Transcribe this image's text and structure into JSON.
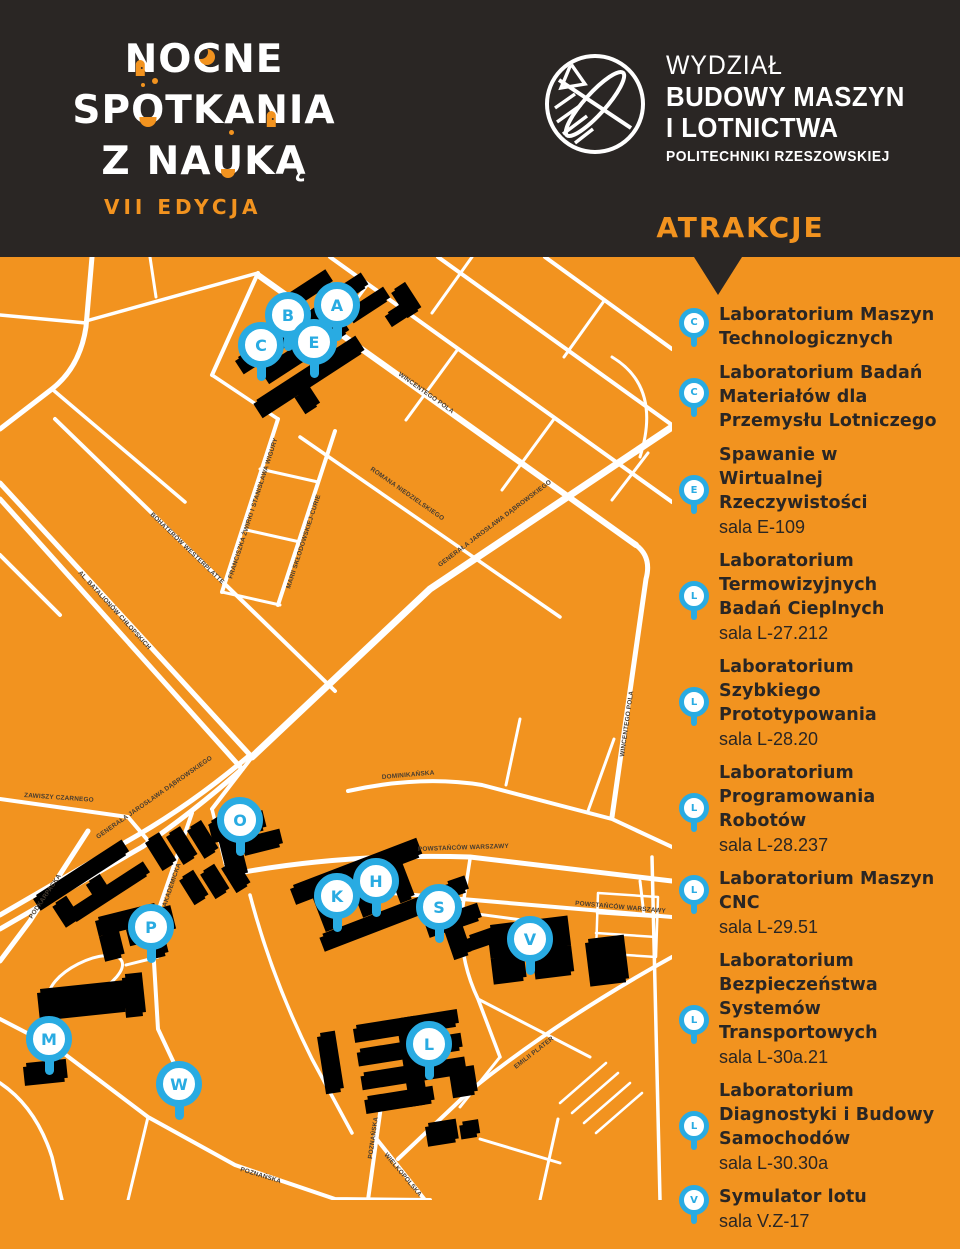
{
  "theme": {
    "orange": "#F2931F",
    "dark": "#2A2624",
    "blue": "#29ABE2",
    "building_black": "#1E1B19",
    "building_gray": "#57524D",
    "white": "#FFFFFF"
  },
  "header": {
    "wordmark": {
      "l1": [
        "N",
        "O",
        "C",
        "N",
        "E"
      ],
      "l2": [
        "S",
        "P",
        "O",
        "T",
        "K",
        "A",
        "N",
        "I",
        "A"
      ],
      "l3": [
        "Z",
        "N",
        "A",
        "U",
        "K",
        "Ą"
      ],
      "edition": "VII EDYCJA"
    },
    "faculty": {
      "line1": "WYDZIAŁ",
      "line2": "BUDOWY MASZYN",
      "line3": "I LOTNICTWA",
      "line4": "POLITECHNIKI RZESZOWSKIEJ"
    },
    "attractions_heading": "ATRAKCJE"
  },
  "map": {
    "pins": [
      {
        "letter": "A"
      },
      {
        "letter": "B"
      },
      {
        "letter": "C"
      },
      {
        "letter": "E"
      },
      {
        "letter": "O"
      },
      {
        "letter": "K"
      },
      {
        "letter": "H"
      },
      {
        "letter": "S"
      },
      {
        "letter": "V"
      },
      {
        "letter": "P"
      },
      {
        "letter": "M"
      },
      {
        "letter": "W"
      },
      {
        "letter": "L"
      }
    ],
    "streets": {
      "al_batalionow": "AL. BATALIONÓW CHŁOPSKICH",
      "bohaterow": "BOHATERÓW WESTERPLATTE",
      "zwirki": "FRANCISZKA ŻWIRKI I STANISŁAWA WIGURY",
      "sklodowskiej": "MARII SKŁODOWSKIEJ-CURIE",
      "wincentego1": "WINCENTEGO POLA",
      "wincentego2": "WINCENTEGO POLA",
      "niedzielskiego": "ROMANA NIEDZIELSKIEGO",
      "dabrowskiego1": "GENERAŁA JAROSŁAWA DĄBROWSKIEGO",
      "dabrowskiego2": "GENERAŁA JAROSŁAWA DĄBROWSKIEGO",
      "zawiszy": "ZAWISZY CZARNEGO",
      "podkarpacka": "PODKARPACKA",
      "dominikanska": "DOMINIKAŃSKA",
      "powstancow1": "POWSTAŃCÓW WARSZAWY",
      "powstancow2": "POWSTAŃCÓW WARSZAWY",
      "akademicka": "AKADEMICKA",
      "poznanska1": "POZNAŃSKA",
      "poznanska2": "POZNAŃSKA",
      "wielkopolska": "WIELKOPOLSKA",
      "emilii": "EMILII PLATER"
    }
  },
  "sidebar": {
    "items": [
      {
        "letter": "C",
        "title": "Laboratorium Maszyn Technologicznych",
        "sala": ""
      },
      {
        "letter": "C",
        "title": "Laboratorium Badań Materiałów dla Przemysłu Lotniczego",
        "sala": ""
      },
      {
        "letter": "E",
        "title": "Spawanie w Wirtualnej Rzeczywistości",
        "sala": "sala E-109"
      },
      {
        "letter": "L",
        "title": "Laboratorium Termowizyjnych Badań Cieplnych",
        "sala": "sala L-27.212"
      },
      {
        "letter": "L",
        "title": "Laboratorium Szybkiego Prototypowania",
        "sala": "sala L-28.20"
      },
      {
        "letter": "L",
        "title": "Laboratorium Programowania Robotów",
        "sala": "sala L-28.237"
      },
      {
        "letter": "L",
        "title": "Laboratorium Maszyn CNC",
        "sala": "sala L-29.51"
      },
      {
        "letter": "L",
        "title": "Laboratorium Bezpieczeństwa Systemów Transportowych",
        "sala": "sala L-30a.21"
      },
      {
        "letter": "L",
        "title": "Laboratorium Diagnostyki i Budowy Samochodów",
        "sala": "sala L-30.30a"
      },
      {
        "letter": "V",
        "title": "Symulator lotu",
        "sala": "sala V.Z-17"
      }
    ]
  }
}
